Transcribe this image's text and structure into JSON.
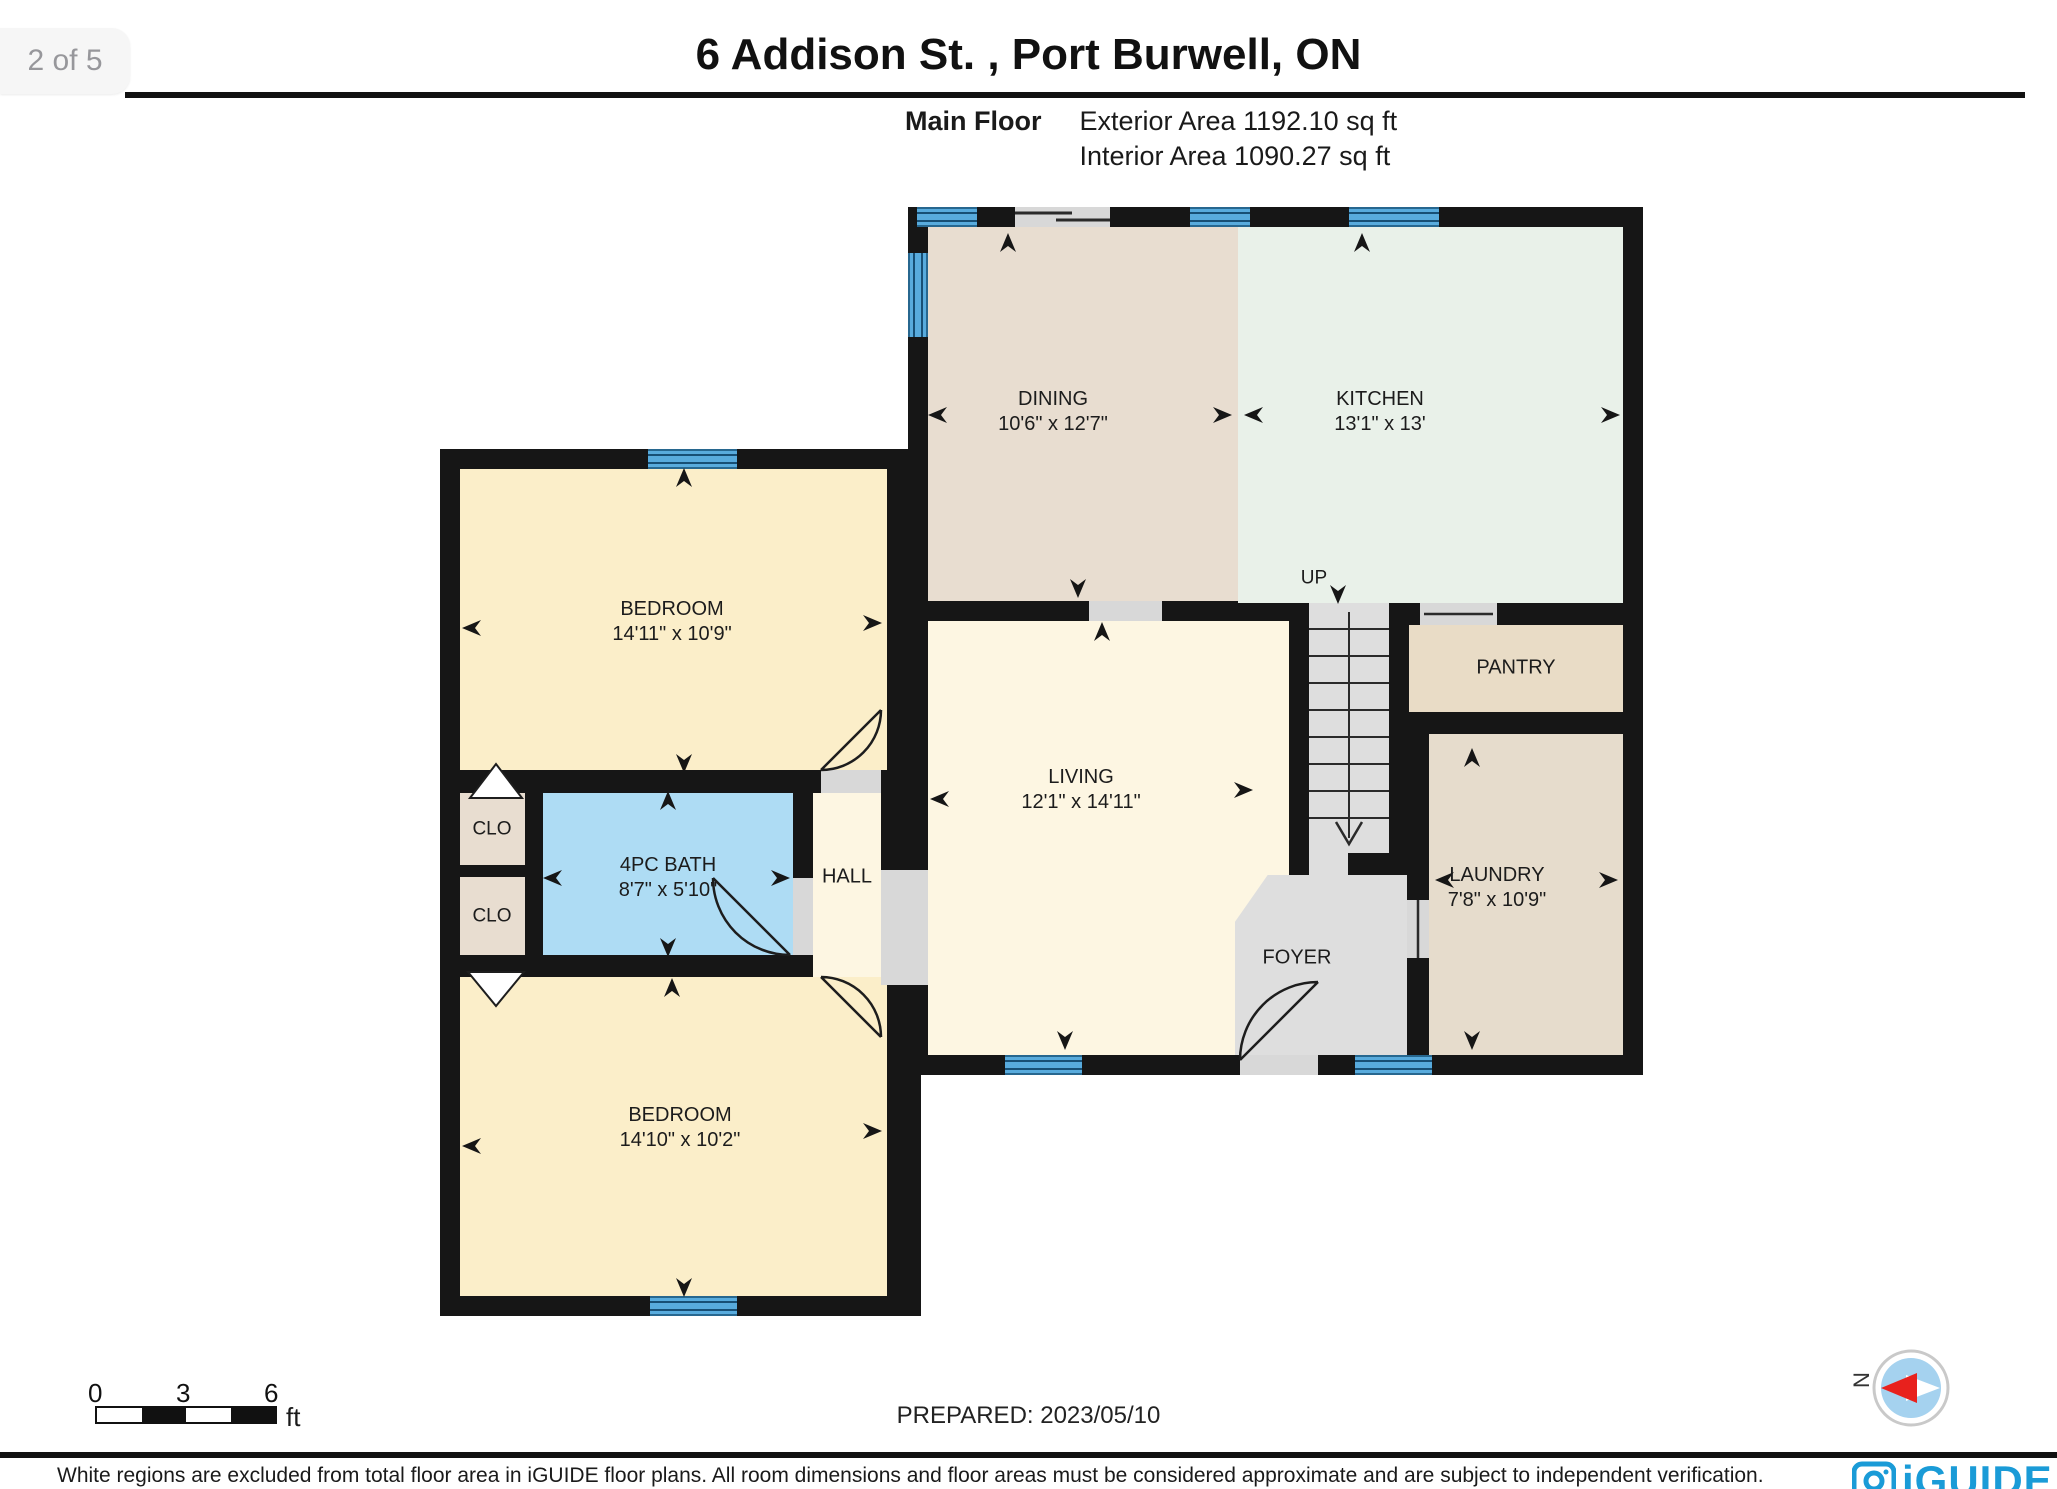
{
  "page": {
    "indicator": "2 of 5",
    "title": "6 Addison St. , Port Burwell, ON"
  },
  "floor_info": {
    "floor": "Main Floor",
    "exterior": "Exterior Area 1192.10 sq ft",
    "interior": "Interior Area 1090.27 sq ft"
  },
  "rooms": {
    "dining": {
      "name": "DINING",
      "dims": "10'6\" x 12'7\""
    },
    "kitchen": {
      "name": "KITCHEN",
      "dims": "13'1\" x 13'"
    },
    "bedroom1": {
      "name": "BEDROOM",
      "dims": "14'11\" x 10'9\""
    },
    "bath": {
      "name": "4PC BATH",
      "dims": "8'7\" x 5'10\""
    },
    "hall": {
      "name": "HALL"
    },
    "clo1": {
      "name": "CLO"
    },
    "clo2": {
      "name": "CLO"
    },
    "living": {
      "name": "LIVING",
      "dims": "12'1\" x 14'11\""
    },
    "pantry": {
      "name": "PANTRY"
    },
    "laundry": {
      "name": "LAUNDRY",
      "dims": "7'8\" x 10'9\""
    },
    "foyer": {
      "name": "FOYER"
    },
    "bedroom2": {
      "name": "BEDROOM",
      "dims": "14'10\" x 10'2\""
    },
    "stairs": {
      "label": "UP"
    }
  },
  "scale_bar": {
    "tick0": "0",
    "tick3": "3",
    "tick6": "6",
    "unit": "ft"
  },
  "footer": {
    "prepared": "PREPARED: 2023/05/10",
    "disclaimer": "White regions are excluded from total floor area in iGUIDE floor plans. All room dimensions and floor areas must be considered approximate and are subject to independent verification.",
    "brand": "iGUIDE"
  },
  "compass": {
    "north_label": "N"
  },
  "colors": {
    "wall": "#161616",
    "dining": "#e8ddd0",
    "kitchen": "#e9f1e9",
    "bedroom": "#fbeec9",
    "living": "#fdf6e2",
    "bath": "#aedcf4",
    "closet": "#e8ddd0",
    "pantry": "#e9dcc6",
    "laundry": "#e6dccc",
    "foyer_stairs": "#dedede",
    "window": "#58abdd",
    "brand_blue": "#1a9bd7",
    "compass_red": "#e8211d",
    "compass_blue": "#a5d2ef"
  }
}
